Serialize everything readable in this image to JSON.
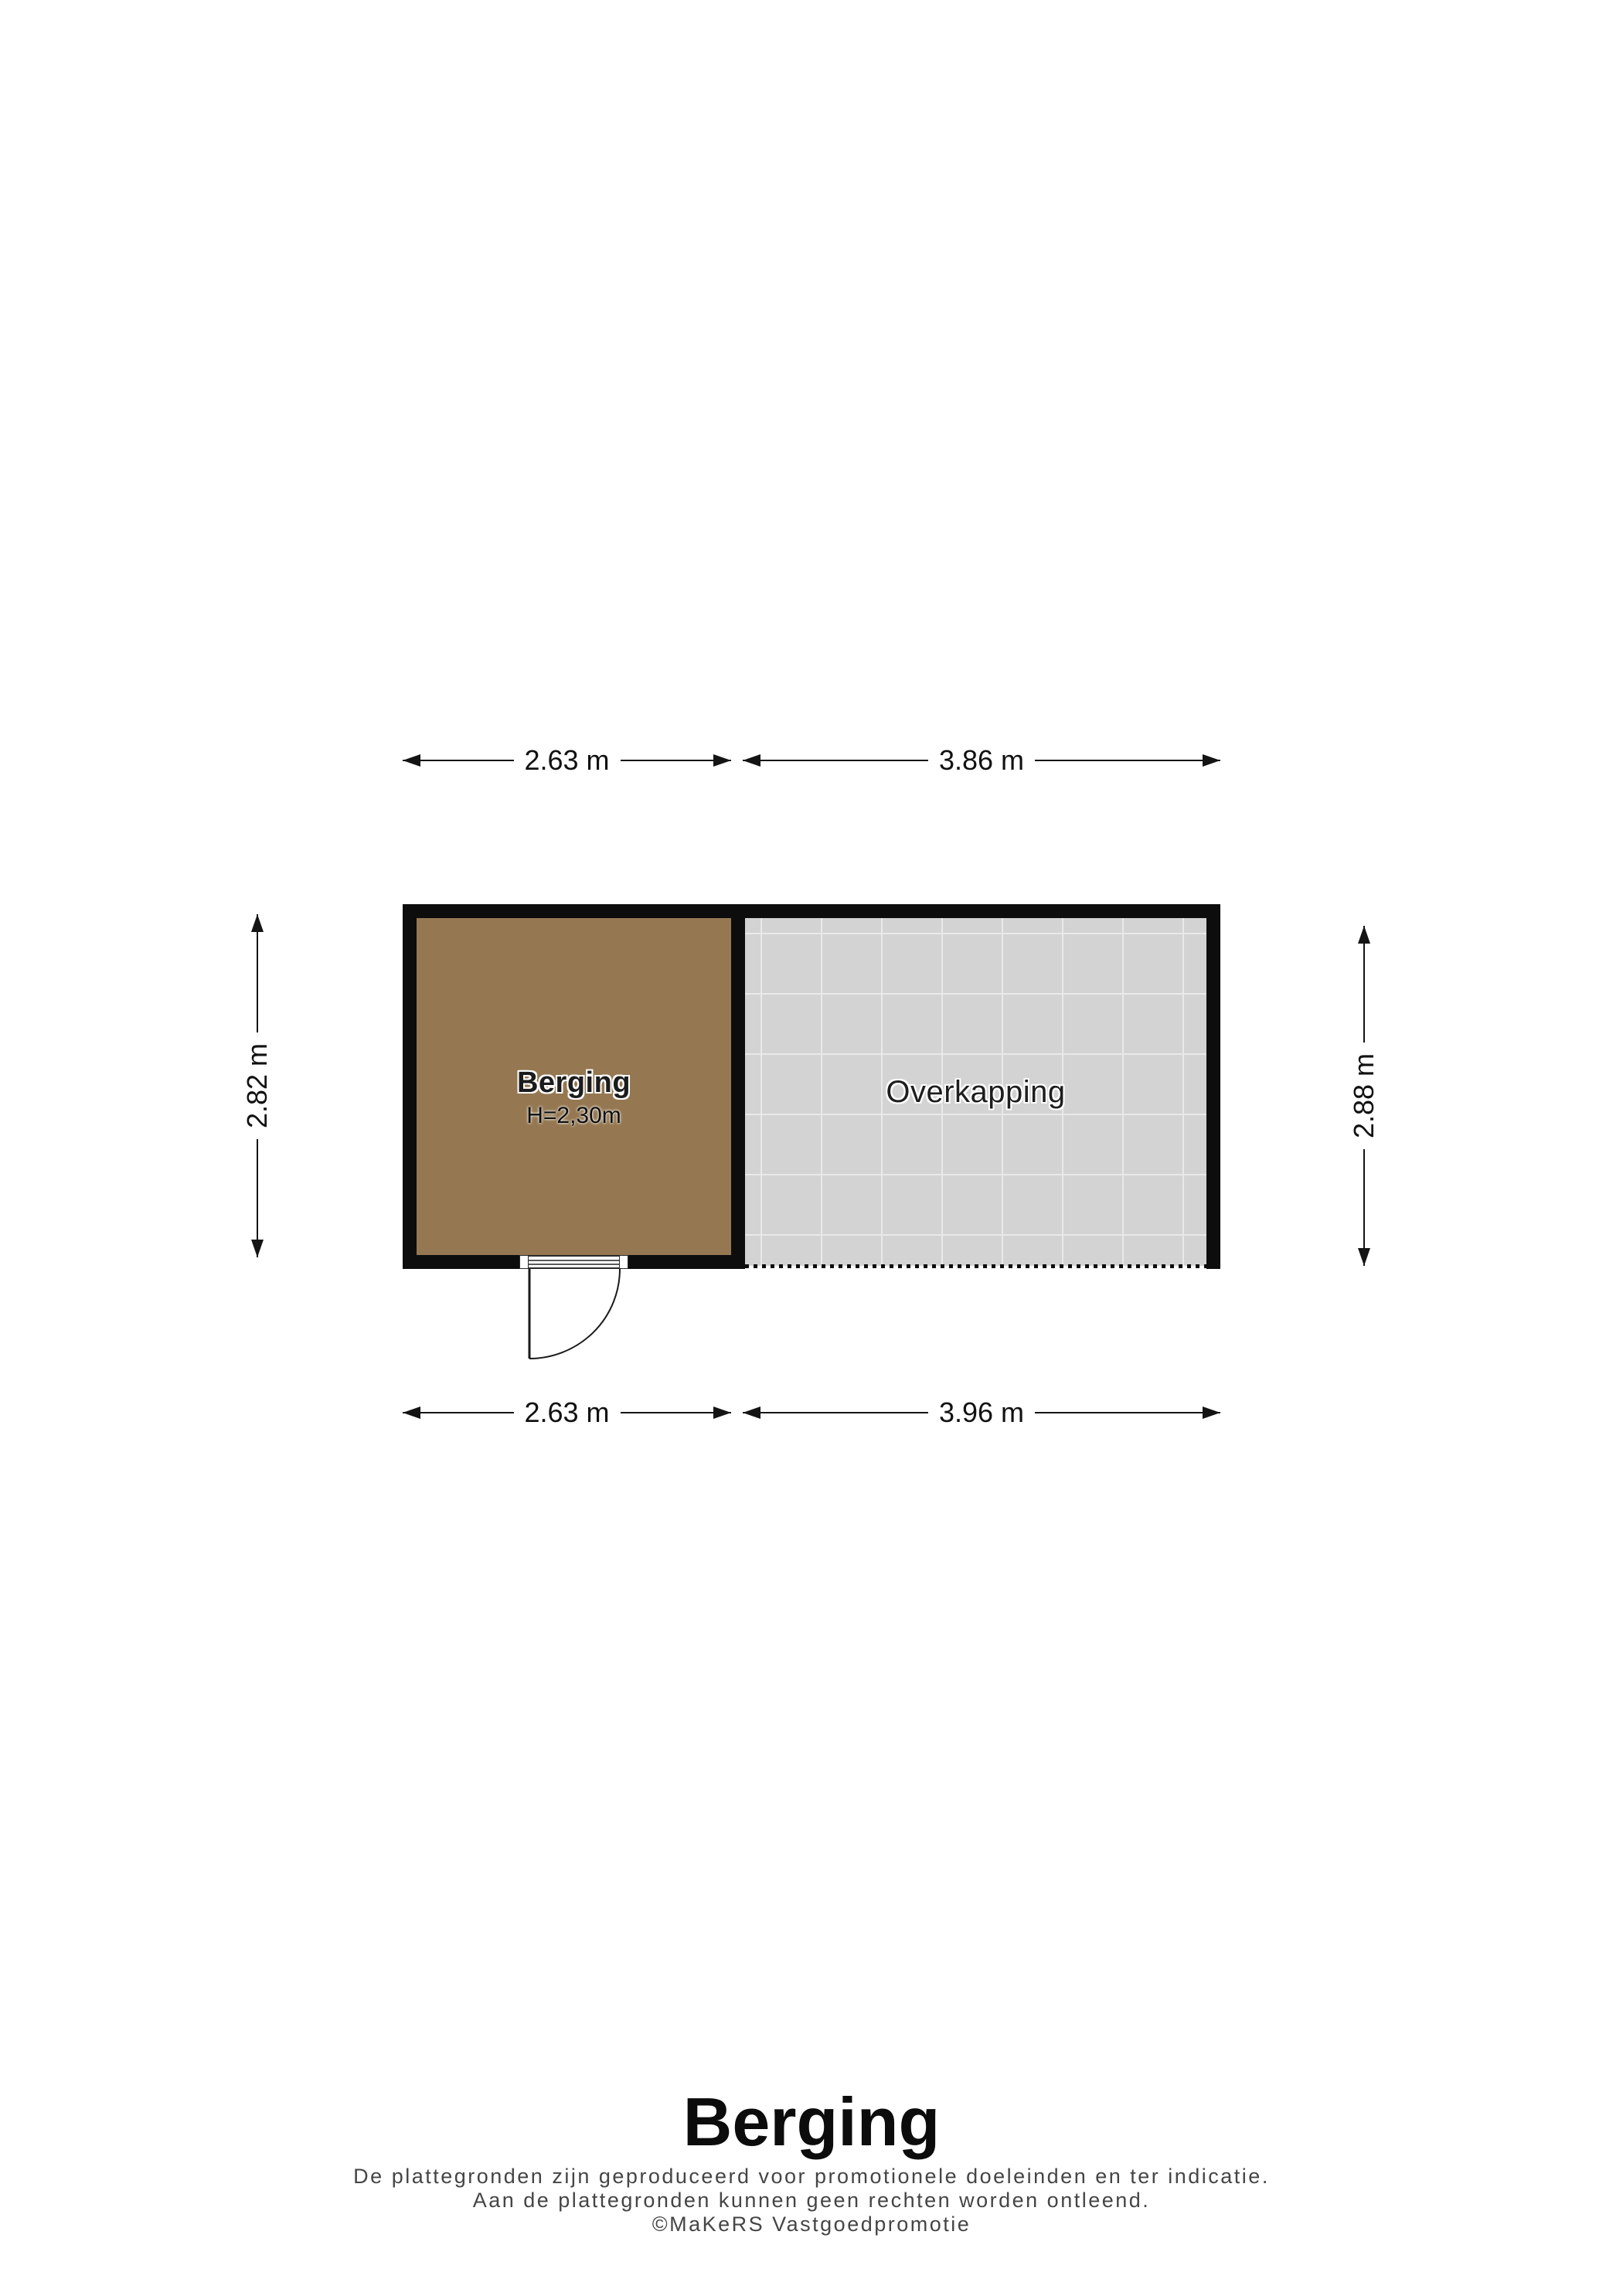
{
  "rooms": {
    "berging": {
      "label": "Berging",
      "ceiling_height": "H=2,30m"
    },
    "overkapping": {
      "label": "Overkapping"
    }
  },
  "dimensions": {
    "top_left": "2.63 m",
    "top_right": "3.86 m",
    "bottom_left": "2.63 m",
    "bottom_right": "3.96 m",
    "left": "2.82 m",
    "right": "2.88 m"
  },
  "footer": {
    "title": "Berging",
    "disclaimer": [
      "De plattegronden zijn geproduceerd voor promotionele doeleinden en ter indicatie.",
      "Aan de plattegronden kunnen geen rechten worden ontleend.",
      "©MaKeRS Vastgoedpromotie"
    ]
  },
  "colors": {
    "wall": "#0d0d0d",
    "berging_floor": "#957852",
    "overkapping_floor": "#d3d3d3",
    "overkapping_grid": "#e9e9e9",
    "footer_text": "#454545"
  }
}
